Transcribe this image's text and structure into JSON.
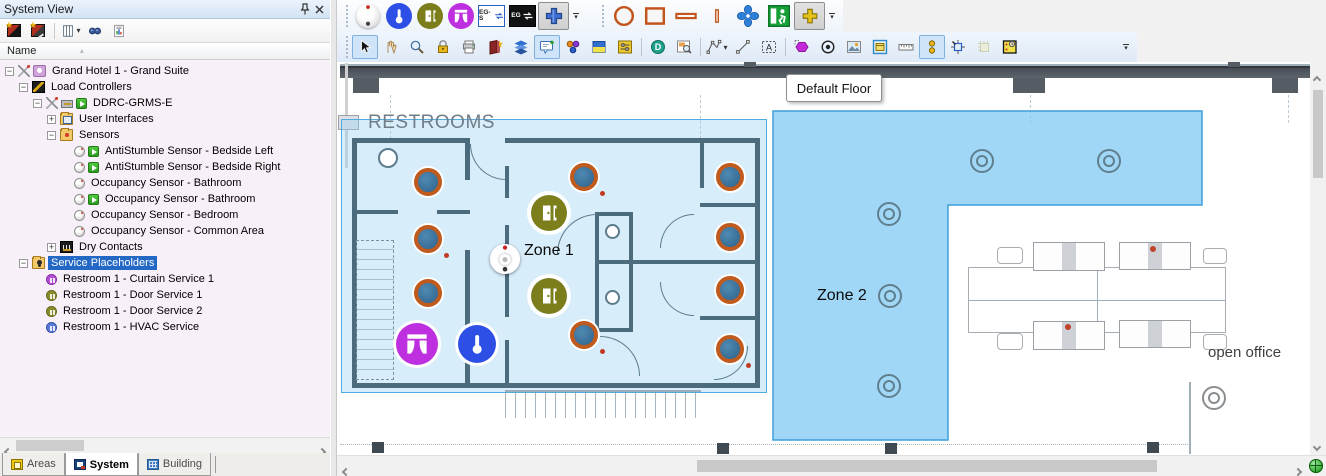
{
  "left_panel": {
    "title": "System View",
    "toolbar": [
      {
        "name": "add-area-button"
      },
      {
        "name": "add-device-button"
      },
      {
        "name": "choose-columns-button",
        "dropdown": true
      },
      {
        "name": "find-button"
      },
      {
        "name": "report-button"
      }
    ],
    "column_header": {
      "label": "Name",
      "sort": "asc"
    },
    "tree": [
      {
        "label": "Grand Hotel 1 - Grand Suite",
        "level": 0,
        "toggle": "-",
        "icon": "ti-hotel",
        "plug": true,
        "play": false,
        "selected": false
      },
      {
        "label": "Load Controllers",
        "level": 1,
        "toggle": "-",
        "icon": "ti-load",
        "play": false,
        "selected": false
      },
      {
        "label": "DDRC-GRMS-E",
        "level": 2,
        "toggle": "-",
        "icon": "ti-chip",
        "plug": true,
        "play": true,
        "selected": false
      },
      {
        "label": "User Interfaces",
        "level": 3,
        "toggle": "+",
        "icon": "ti-folder ti-folder-ui",
        "play": false,
        "selected": false
      },
      {
        "label": "Sensors",
        "level": 3,
        "toggle": "-",
        "icon": "ti-folder ti-folder-sensors",
        "play": false,
        "selected": false
      },
      {
        "label": "AntiStumble Sensor - Bedside Left",
        "level": 4,
        "toggle": null,
        "icon": "ti-sensor",
        "play": true,
        "selected": false
      },
      {
        "label": "AntiStumble Sensor - Bedside Right",
        "level": 4,
        "toggle": null,
        "icon": "ti-sensor",
        "play": true,
        "selected": false
      },
      {
        "label": "Occupancy Sensor - Bathroom",
        "level": 4,
        "toggle": null,
        "icon": "ti-sensor",
        "play": false,
        "selected": false
      },
      {
        "label": "Occupancy Sensor - Bathroom",
        "level": 4,
        "toggle": null,
        "icon": "ti-sensor",
        "play": true,
        "selected": false
      },
      {
        "label": "Occupancy Sensor - Bedroom",
        "level": 4,
        "toggle": null,
        "icon": "ti-sensor",
        "play": false,
        "selected": false
      },
      {
        "label": "Occupancy Sensor - Common Area",
        "level": 4,
        "toggle": null,
        "icon": "ti-sensor",
        "play": false,
        "selected": false
      },
      {
        "label": "Dry Contacts",
        "level": 3,
        "toggle": "+",
        "icon": "ti-dry",
        "play": false,
        "selected": false
      },
      {
        "label": "Service Placeholders",
        "level": 1,
        "toggle": "-",
        "icon": "ti-folder ti-folder-svc",
        "play": false,
        "selected": true
      },
      {
        "label": "Restroom 1 - Curtain Service 1",
        "level": 2,
        "toggle": null,
        "icon": "ti-svc ti-svc-curtain",
        "play": false,
        "selected": false
      },
      {
        "label": "Restroom 1 - Door Service 1",
        "level": 2,
        "toggle": null,
        "icon": "ti-svc ti-svc-door",
        "play": false,
        "selected": false
      },
      {
        "label": "Restroom 1 - Door Service 2",
        "level": 2,
        "toggle": null,
        "icon": "ti-svc ti-svc-door",
        "play": false,
        "selected": false
      },
      {
        "label": "Restroom 1 - HVAC Service",
        "level": 2,
        "toggle": null,
        "icon": "ti-svc ti-svc-hvac",
        "play": false,
        "selected": false
      }
    ],
    "tabs": [
      {
        "label": "Areas",
        "active": false,
        "icon": "tbi-areas"
      },
      {
        "label": "System",
        "active": true,
        "icon": "tbi-system"
      },
      {
        "label": "Building",
        "active": false,
        "icon": "tbi-building"
      }
    ]
  },
  "right_panel": {
    "device_toolbar": [
      {
        "name": "occupancy-sensor-tool"
      },
      {
        "name": "thermostat-tool"
      },
      {
        "name": "door-service-tool"
      },
      {
        "name": "curtain-service-tool"
      },
      {
        "name": "eg-s-swap-tool",
        "label": "EG-S"
      },
      {
        "name": "eg-swap-tool",
        "label": "EG"
      },
      {
        "name": "add-service-tool",
        "pressed": true
      }
    ],
    "shape_toolbar": [
      {
        "name": "ellipse-shape-tool"
      },
      {
        "name": "rectangle-shape-tool"
      },
      {
        "name": "hbar-shape-tool"
      },
      {
        "name": "vbar-shape-tool"
      },
      {
        "name": "fan-tool"
      },
      {
        "name": "exit-sign-tool"
      },
      {
        "name": "add-shape-tool",
        "pressed": true
      }
    ],
    "edit_toolbar": [
      {
        "name": "select-tool",
        "selected": true
      },
      {
        "name": "pan-tool"
      },
      {
        "name": "zoom-tool"
      },
      {
        "name": "lock-tool"
      },
      {
        "name": "print-tool"
      },
      {
        "name": "library-tool"
      },
      {
        "name": "layers-tool"
      },
      {
        "name": "note-tool",
        "selected": true
      },
      {
        "name": "group-colors-tool"
      },
      {
        "name": "fill-tool"
      },
      {
        "name": "adjust-tool"
      },
      {
        "sep": true
      },
      {
        "name": "demo-mode-tool"
      },
      {
        "name": "zoom-region-tool"
      },
      {
        "sep": true
      },
      {
        "name": "draw-polygon-tool",
        "dropdown": true
      },
      {
        "name": "draw-line-tool"
      },
      {
        "name": "text-region-tool"
      },
      {
        "sep": true
      },
      {
        "name": "region-shape-tool"
      },
      {
        "name": "center-view-tool"
      },
      {
        "name": "background-image-tool"
      },
      {
        "name": "background-select-tool"
      },
      {
        "name": "ruler-tool"
      },
      {
        "name": "align-tool",
        "selected": true
      },
      {
        "name": "snap-grid-tool"
      },
      {
        "name": "paste-grid-tool",
        "disabled": true
      },
      {
        "name": "schedule-tool"
      }
    ],
    "floor_label": "Default Floor",
    "floorplan": {
      "restrooms_label": "RESTROOMS",
      "open_office_label": "open office",
      "zone1": {
        "label": "Zone 1"
      },
      "zone2": {
        "label": "Zone 2"
      },
      "devices": {
        "occupancy": [
          {
            "x": 432,
            "y": 186
          },
          {
            "x": 432,
            "y": 243,
            "dot": true
          },
          {
            "x": 432,
            "y": 297
          },
          {
            "x": 588,
            "y": 181,
            "dot": true
          },
          {
            "x": 588,
            "y": 339,
            "dot": true
          },
          {
            "x": 734,
            "y": 181
          },
          {
            "x": 734,
            "y": 241
          },
          {
            "x": 734,
            "y": 294
          },
          {
            "x": 734,
            "y": 353,
            "dot": true
          }
        ],
        "doors": [
          {
            "x": 553,
            "y": 217
          },
          {
            "x": 553,
            "y": 300
          }
        ],
        "motion_sensor": {
          "x": 505,
          "y": 259
        },
        "curtain": {
          "x": 420,
          "y": 347
        },
        "hvac": {
          "x": 480,
          "y": 347
        },
        "ceiling_lights": [
          {
            "x": 983,
            "y": 162
          },
          {
            "x": 1110,
            "y": 162
          },
          {
            "x": 890,
            "y": 215
          },
          {
            "x": 891,
            "y": 297
          },
          {
            "x": 890,
            "y": 387
          },
          {
            "x": 1215,
            "y": 399,
            "gray": true
          }
        ]
      }
    },
    "colors": {
      "occupancy_ring": "#c05a1d",
      "occupancy_fill": "#2e618b",
      "door_service": "#7b7e1b",
      "curtain_service": "#bd2fdf",
      "hvac_service": "#2d4fe6",
      "zone_fill": "#8ecdf3",
      "zone_border": "#54abdf",
      "selection": "#2368c4"
    }
  }
}
